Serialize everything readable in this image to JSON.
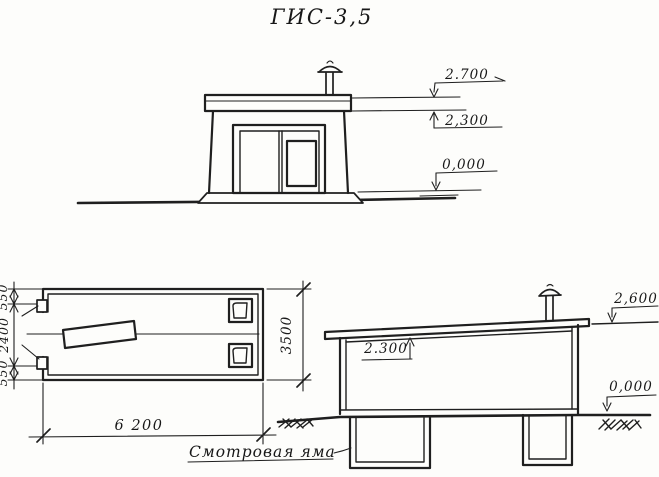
{
  "title": "ГИС-3,5",
  "front_elevation": {
    "mark_roof_top": "2.700",
    "mark_ceiling": "2,300",
    "mark_ground": "0,000"
  },
  "plan_view": {
    "dim_left_top": "550",
    "dim_left_middle": "2400",
    "dim_left_bottom": "550",
    "dim_bottom_width": "6 200",
    "dim_right_depth": "3500"
  },
  "section_view": {
    "mark_roof": "2,600",
    "mark_ceiling": "2.300",
    "mark_ground": "0,000",
    "pit_label": "Смотровая яма"
  }
}
